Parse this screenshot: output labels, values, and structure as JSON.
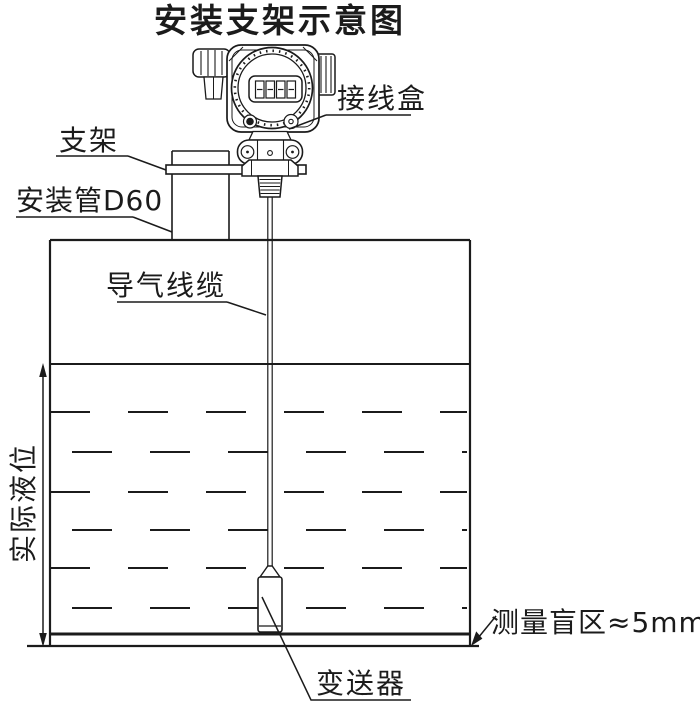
{
  "title": "安装支架示意图",
  "labels": {
    "junction_box": "接线盒",
    "bracket": "支架",
    "mounting_pipe": "安装管D60",
    "air_cable": "导气线缆",
    "actual_level": "实际液位",
    "blind_zone": "测量盲区≈5mm",
    "transmitter": "变送器"
  },
  "display": {
    "value": "8888"
  },
  "colors": {
    "line": "#1b1b1b",
    "background": "#ffffff"
  }
}
